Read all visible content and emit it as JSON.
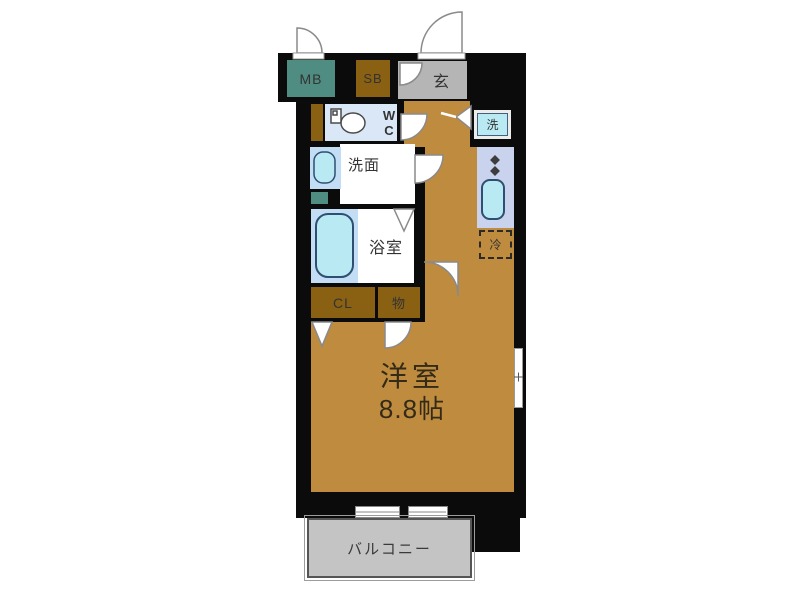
{
  "colors": {
    "wall": "#0b0b0b",
    "floor": "#bf8b3e",
    "teal": "#4f8c82",
    "brown": "#8a6113",
    "genkan": "#b5b5b5",
    "balcony": "#c4c4c4",
    "wc_bg": "#d9e7f7",
    "wet_bg": "#c3ddf4",
    "fixture": "#b9eaf4",
    "kitchen": "#c9d3ed",
    "ink": "#333333"
  },
  "labels": {
    "meter_box": "MB",
    "shoe_box": "SB",
    "entrance": "玄",
    "toilet": "W\nC",
    "washroom": "洗面",
    "bathroom": "浴室",
    "closet": "CL",
    "storage": "物",
    "washer": "洗",
    "fridge": "冷",
    "balcony": "バルコニー"
  },
  "room": {
    "name": "洋室",
    "size": "8.8帖"
  }
}
